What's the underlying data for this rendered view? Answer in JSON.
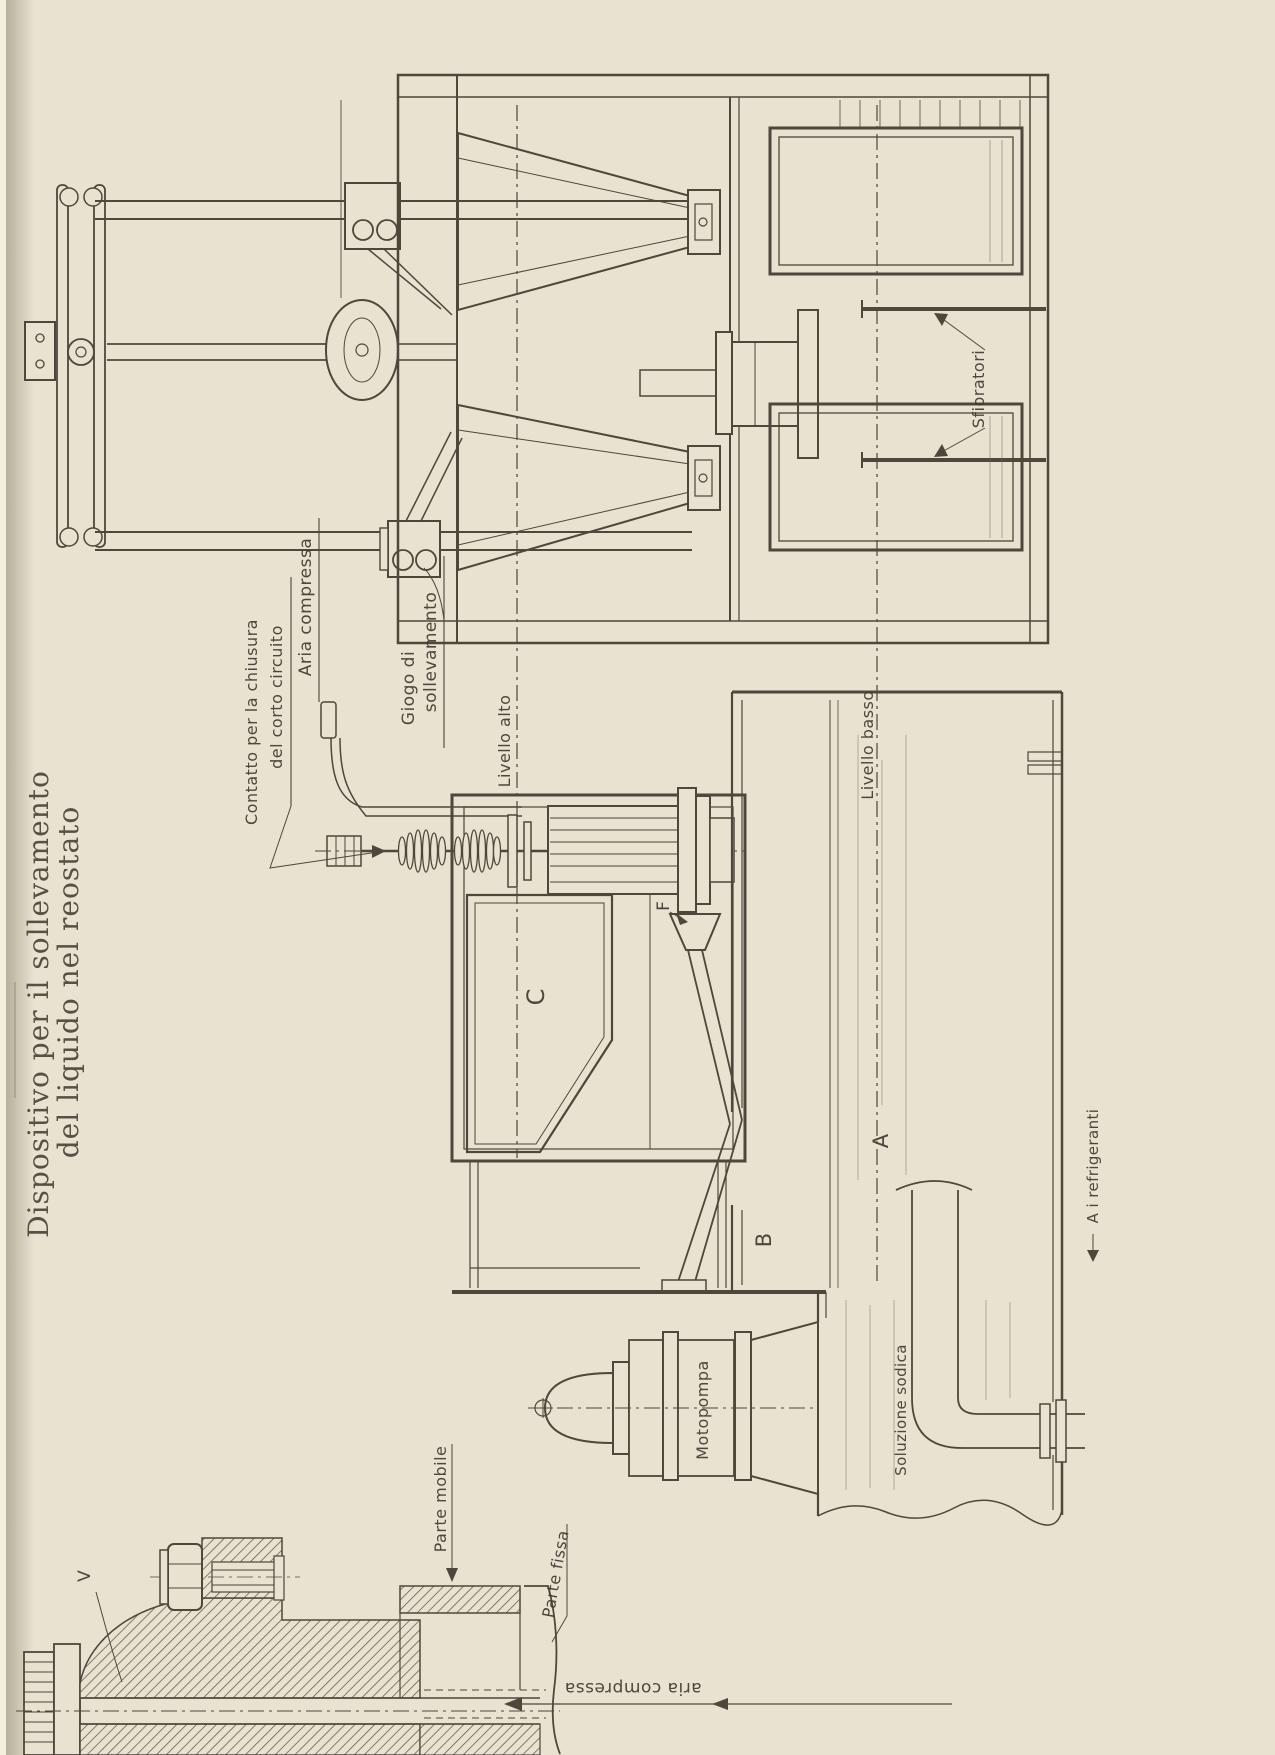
{
  "colors": {
    "paper": "#e8e2d0",
    "ink": "#4e473b",
    "text": "#3f3930"
  },
  "title": {
    "line1": "Dispositivo per il sollevamento",
    "line2": "del liquido nel reostato"
  },
  "labels": {
    "aria_compressa": "Aria compressa",
    "giogo_line1": "Giogo di",
    "giogo_line2": "sollevamento",
    "contatto_line1": "Contatto per la chiusura",
    "contatto_line2": "del corto circuito",
    "livello_alto": "Livello alto",
    "livello_basso": "Livello basso",
    "sfioratori": "Sfioratori",
    "motopompa": "Motopompa",
    "parte_mobile": "Parte mobile",
    "parte_fissa": "Parte fissa",
    "aria_compressa_bottom": "aria compressa",
    "soluzione_sodica": "Soluzione sodica",
    "refrigeranti": "A i refrigeranti"
  },
  "letters": {
    "v": "V",
    "c": "C",
    "b": "B",
    "a": "A",
    "f": "F"
  }
}
